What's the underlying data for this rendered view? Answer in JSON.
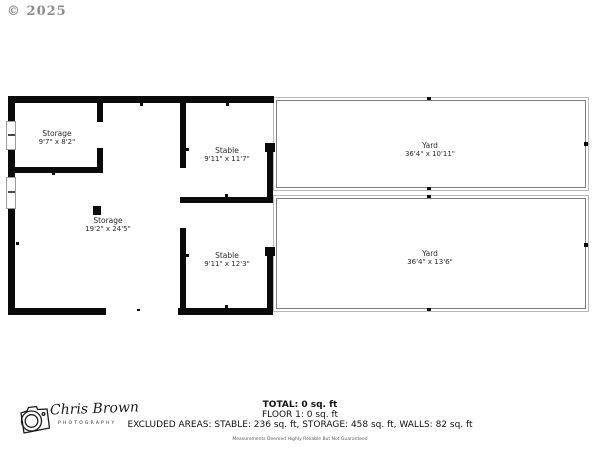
{
  "copyright": "© 2025",
  "floorplan": {
    "rooms": [
      {
        "name": "Storage",
        "dims": "9'7\" x 8'2\""
      },
      {
        "name": "Stable",
        "dims": "9'11\" x 11'7\""
      },
      {
        "name": "Yard",
        "dims": "36'4\" x 10'11\""
      },
      {
        "name": "Storage",
        "dims": "19'2\" x 24'5\""
      },
      {
        "name": "Stable",
        "dims": "9'11\" x 12'3\""
      },
      {
        "name": "Yard",
        "dims": "36'4\" x 13'6\""
      }
    ],
    "colors": {
      "wall": "#0a0a0a",
      "yard_line_outer": "#b8b8b8",
      "yard_line_inner": "#7d7d7d"
    }
  },
  "footer": {
    "total": "TOTAL: 0 sq. ft",
    "floor": "FLOOR 1: 0 sq. ft",
    "excluded": "EXCLUDED AREAS: STABLE: 236 sq. ft, STORAGE: 458 sq. ft, WALLS: 82 sq. ft",
    "disclaimer": "Measurements Deemed Highly Reliable But Not Guaranteed"
  },
  "logo": {
    "name": "Chris Brown",
    "subtitle": "PHOTOGRAPHY"
  }
}
